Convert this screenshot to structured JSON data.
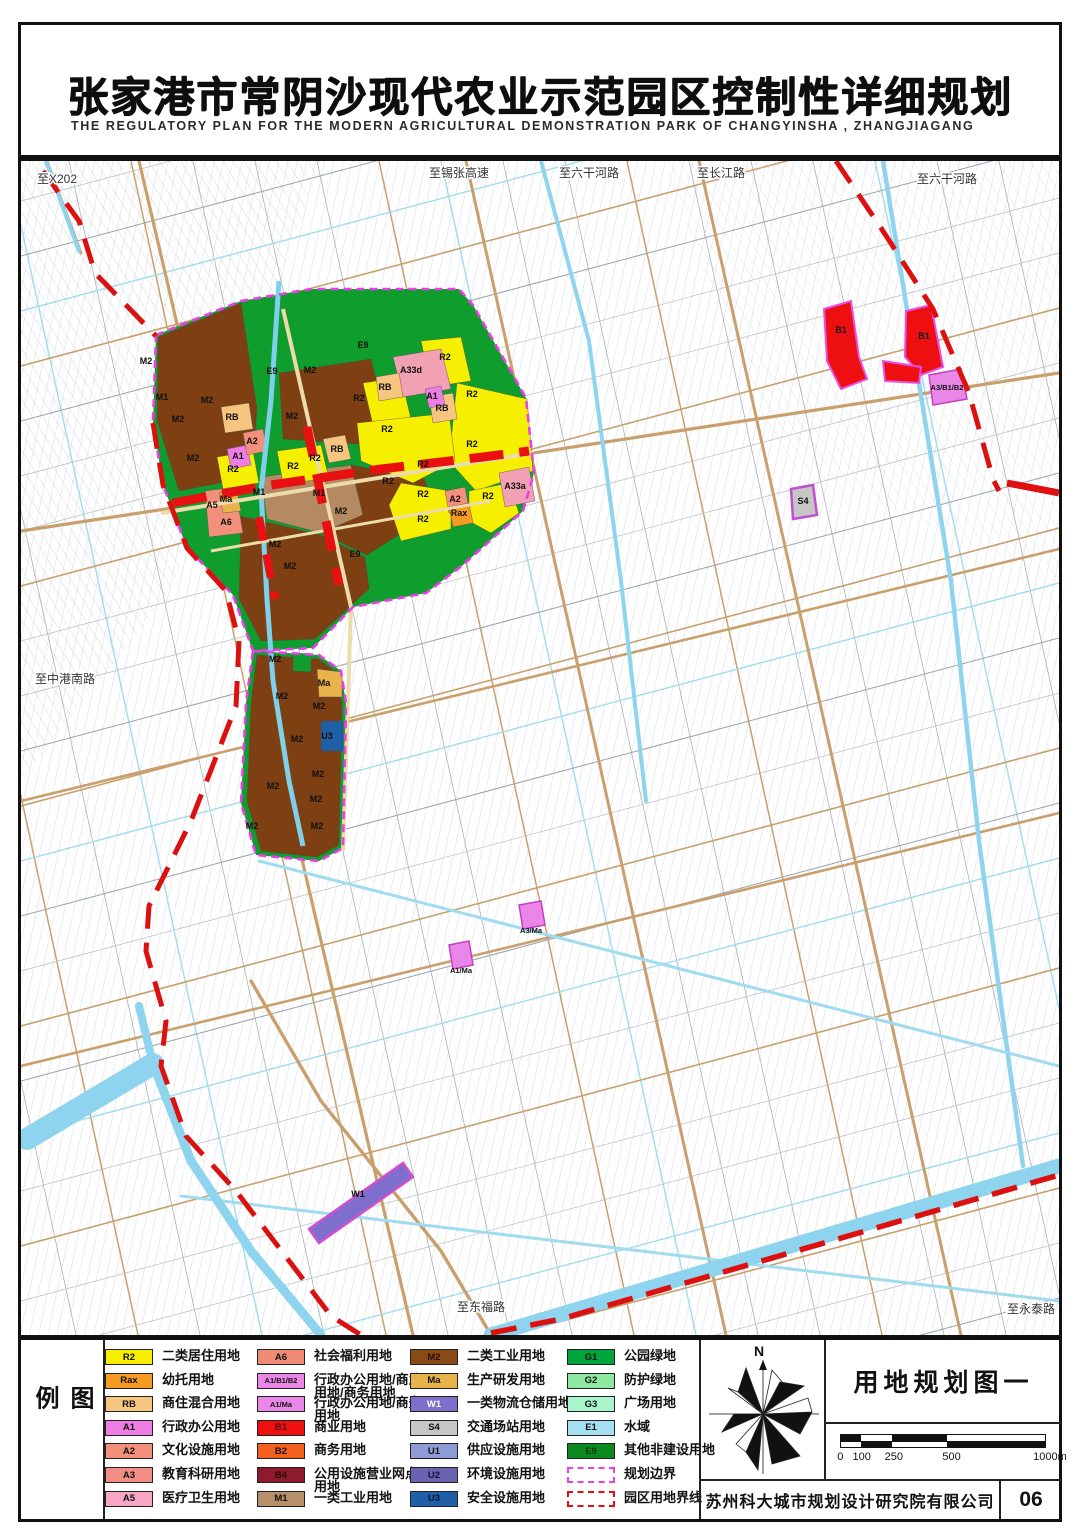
{
  "header": {
    "title": "张家港市常阴沙现代农业示范园区控制性详细规划",
    "subtitle": "THE REGULATORY PLAN FOR THE MODERN AGRICULTURAL DEMONSTRATION PARK OF CHANGYINSHA , ZHANGJIAGANG"
  },
  "legend": {
    "section_label": "图例",
    "columns": [
      [
        {
          "code": "R2",
          "label": "二类居住用地",
          "bg": "#f7ef00",
          "fg": "#111"
        },
        {
          "code": "Rax",
          "label": "幼托用地",
          "bg": "#f59a23",
          "fg": "#111"
        },
        {
          "code": "RB",
          "label": "商住混合用地",
          "bg": "#f6c57f",
          "fg": "#111"
        },
        {
          "code": "A1",
          "label": "行政办公用地",
          "bg": "#ee7ee4",
          "fg": "#111"
        },
        {
          "code": "A2",
          "label": "文化设施用地",
          "bg": "#f2907b",
          "fg": "#111"
        },
        {
          "code": "A3",
          "label": "教育科研用地",
          "bg": "#f28e84",
          "fg": "#111"
        },
        {
          "code": "A5",
          "label": "医疗卫生用地",
          "bg": "#f7a6c5",
          "fg": "#111"
        }
      ],
      [
        {
          "code": "A6",
          "label": "社会福利用地",
          "bg": "#ef8a74",
          "fg": "#111"
        },
        {
          "code": "A1/B1/B2",
          "label": "行政办公用地/商业用地/商务用地",
          "bg": "#ea86e8",
          "fg": "#111"
        },
        {
          "code": "A1/Ma",
          "label": "行政办公用地/商务用地",
          "bg": "#ea86e8",
          "fg": "#111"
        },
        {
          "code": "B1",
          "label": "商业用地",
          "bg": "#ee0f0f",
          "fg": "#5a0000"
        },
        {
          "code": "B2",
          "label": "商务用地",
          "bg": "#f4611e",
          "fg": "#111"
        },
        {
          "code": "B4",
          "label": "公用设施营业网点用地",
          "bg": "#8e1a2e",
          "fg": "#2a0008"
        },
        {
          "code": "M1",
          "label": "一类工业用地",
          "bg": "#b5906b",
          "fg": "#111"
        }
      ],
      [
        {
          "code": "M2",
          "label": "二类工业用地",
          "bg": "#8a4a16",
          "fg": "#2e1200"
        },
        {
          "code": "Ma",
          "label": "生产研发用地",
          "bg": "#e8b34b",
          "fg": "#111"
        },
        {
          "code": "W1",
          "label": "一类物流仓储用地",
          "bg": "#7f6fcc",
          "fg": "#ffffff"
        },
        {
          "code": "S4",
          "label": "交通场站用地",
          "bg": "#c6c6c6",
          "fg": "#111"
        },
        {
          "code": "U1",
          "label": "供应设施用地",
          "bg": "#8f9ad8",
          "fg": "#111"
        },
        {
          "code": "U2",
          "label": "环境设施用地",
          "bg": "#6a64b0",
          "fg": "#10103a"
        },
        {
          "code": "U3",
          "label": "安全设施用地",
          "bg": "#1f5fa8",
          "fg": "#06172e"
        }
      ],
      [
        {
          "code": "G1",
          "label": "公园绿地",
          "bg": "#00a43c",
          "fg": "#111"
        },
        {
          "code": "G2",
          "label": "防护绿地",
          "bg": "#8fe89f",
          "fg": "#111"
        },
        {
          "code": "G3",
          "label": "广场用地",
          "bg": "#a9f3cd",
          "fg": "#111"
        },
        {
          "code": "E1",
          "label": "水域",
          "bg": "#a5dff2",
          "fg": "#111"
        },
        {
          "code": "E9",
          "label": "其他非建设用地",
          "bg": "#0c8a1f",
          "fg": "#053a0c"
        },
        {
          "code": "",
          "label": "规划边界",
          "type": "dash-magenta"
        },
        {
          "code": "",
          "label": "园区用地界线",
          "type": "dash-red"
        }
      ]
    ]
  },
  "titleblock": {
    "north_label": "N",
    "map_title": "用地规划图一",
    "scale_ticks": [
      "0",
      "100",
      "250",
      "500",
      "1000m"
    ],
    "company": "苏州科大城市规划设计研究院有限公司",
    "page_no": "06"
  },
  "map": {
    "colors": {
      "park_boundary_red": "#dd1010",
      "plan_boundary_magenta": "#e83fe8",
      "water_blue": "#8fd4ee",
      "road_tan": "#c9a06c",
      "field_line_gray": "#b7bfc8"
    },
    "edge_labels": [
      {
        "text": "至X202",
        "x": 16,
        "y": 22
      },
      {
        "text": "至锡张高速",
        "x": 408,
        "y": 16
      },
      {
        "text": "至六干河路",
        "x": 538,
        "y": 16
      },
      {
        "text": "至长江路",
        "x": 676,
        "y": 16
      },
      {
        "text": "至六干河路",
        "x": 896,
        "y": 22
      },
      {
        "text": "至中港南路",
        "x": 14,
        "y": 522
      },
      {
        "text": "至东福路",
        "x": 436,
        "y": 1150
      },
      {
        "text": "至永泰路",
        "x": 986,
        "y": 1152
      }
    ],
    "parcel_labels": [
      {
        "t": "M2",
        "x": 125,
        "y": 203
      },
      {
        "t": "M1",
        "x": 141,
        "y": 239
      },
      {
        "t": "M2",
        "x": 157,
        "y": 261
      },
      {
        "t": "M2",
        "x": 186,
        "y": 242
      },
      {
        "t": "M2",
        "x": 172,
        "y": 300
      },
      {
        "t": "E9",
        "x": 251,
        "y": 213
      },
      {
        "t": "E9",
        "x": 342,
        "y": 187
      },
      {
        "t": "M2",
        "x": 289,
        "y": 212
      },
      {
        "t": "M2",
        "x": 271,
        "y": 258
      },
      {
        "t": "R2",
        "x": 338,
        "y": 240
      },
      {
        "t": "RB",
        "x": 364,
        "y": 229
      },
      {
        "t": "A33d",
        "x": 390,
        "y": 212
      },
      {
        "t": "R2",
        "x": 424,
        "y": 199
      },
      {
        "t": "A1",
        "x": 411,
        "y": 238
      },
      {
        "t": "RB",
        "x": 421,
        "y": 250
      },
      {
        "t": "R2",
        "x": 451,
        "y": 236
      },
      {
        "t": "R2",
        "x": 366,
        "y": 271
      },
      {
        "t": "R2",
        "x": 402,
        "y": 306
      },
      {
        "t": "R2",
        "x": 451,
        "y": 286
      },
      {
        "t": "A2",
        "x": 231,
        "y": 283
      },
      {
        "t": "A1",
        "x": 217,
        "y": 298
      },
      {
        "t": "R2",
        "x": 212,
        "y": 311
      },
      {
        "t": "RB",
        "x": 211,
        "y": 259
      },
      {
        "t": "R2",
        "x": 272,
        "y": 308
      },
      {
        "t": "R2",
        "x": 294,
        "y": 300
      },
      {
        "t": "RB",
        "x": 316,
        "y": 291
      },
      {
        "t": "M1",
        "x": 238,
        "y": 334
      },
      {
        "t": "M1",
        "x": 298,
        "y": 335
      },
      {
        "t": "M2",
        "x": 320,
        "y": 353
      },
      {
        "t": "M2",
        "x": 254,
        "y": 386
      },
      {
        "t": "M2",
        "x": 269,
        "y": 408
      },
      {
        "t": "R2",
        "x": 402,
        "y": 336
      },
      {
        "t": "R2",
        "x": 367,
        "y": 323
      },
      {
        "t": "A2",
        "x": 434,
        "y": 341
      },
      {
        "t": "Rax",
        "x": 438,
        "y": 355
      },
      {
        "t": "R2",
        "x": 467,
        "y": 338
      },
      {
        "t": "A33a",
        "x": 494,
        "y": 328
      },
      {
        "t": "R2",
        "x": 402,
        "y": 361
      },
      {
        "t": "Ma",
        "x": 205,
        "y": 341
      },
      {
        "t": "A5",
        "x": 191,
        "y": 347
      },
      {
        "t": "A6",
        "x": 205,
        "y": 364
      },
      {
        "t": "E9",
        "x": 334,
        "y": 396
      },
      {
        "t": "M2",
        "x": 254,
        "y": 501
      },
      {
        "t": "Ma",
        "x": 303,
        "y": 525
      },
      {
        "t": "M2",
        "x": 261,
        "y": 538
      },
      {
        "t": "M2",
        "x": 298,
        "y": 548
      },
      {
        "t": "M2",
        "x": 276,
        "y": 581
      },
      {
        "t": "U3",
        "x": 306,
        "y": 578
      },
      {
        "t": "M2",
        "x": 297,
        "y": 616
      },
      {
        "t": "M2",
        "x": 252,
        "y": 628
      },
      {
        "t": "M2",
        "x": 295,
        "y": 641
      },
      {
        "t": "M2",
        "x": 231,
        "y": 668
      },
      {
        "t": "M2",
        "x": 296,
        "y": 668
      },
      {
        "t": "B1",
        "x": 820,
        "y": 172
      },
      {
        "t": "B1",
        "x": 903,
        "y": 178
      },
      {
        "t": "A3/B1/B2",
        "x": 926,
        "y": 229
      },
      {
        "t": "S4",
        "x": 782,
        "y": 343
      },
      {
        "t": "A3/Ma",
        "x": 510,
        "y": 772
      },
      {
        "t": "A1/Ma",
        "x": 440,
        "y": 812
      },
      {
        "t": "W1",
        "x": 337,
        "y": 1036
      }
    ]
  }
}
